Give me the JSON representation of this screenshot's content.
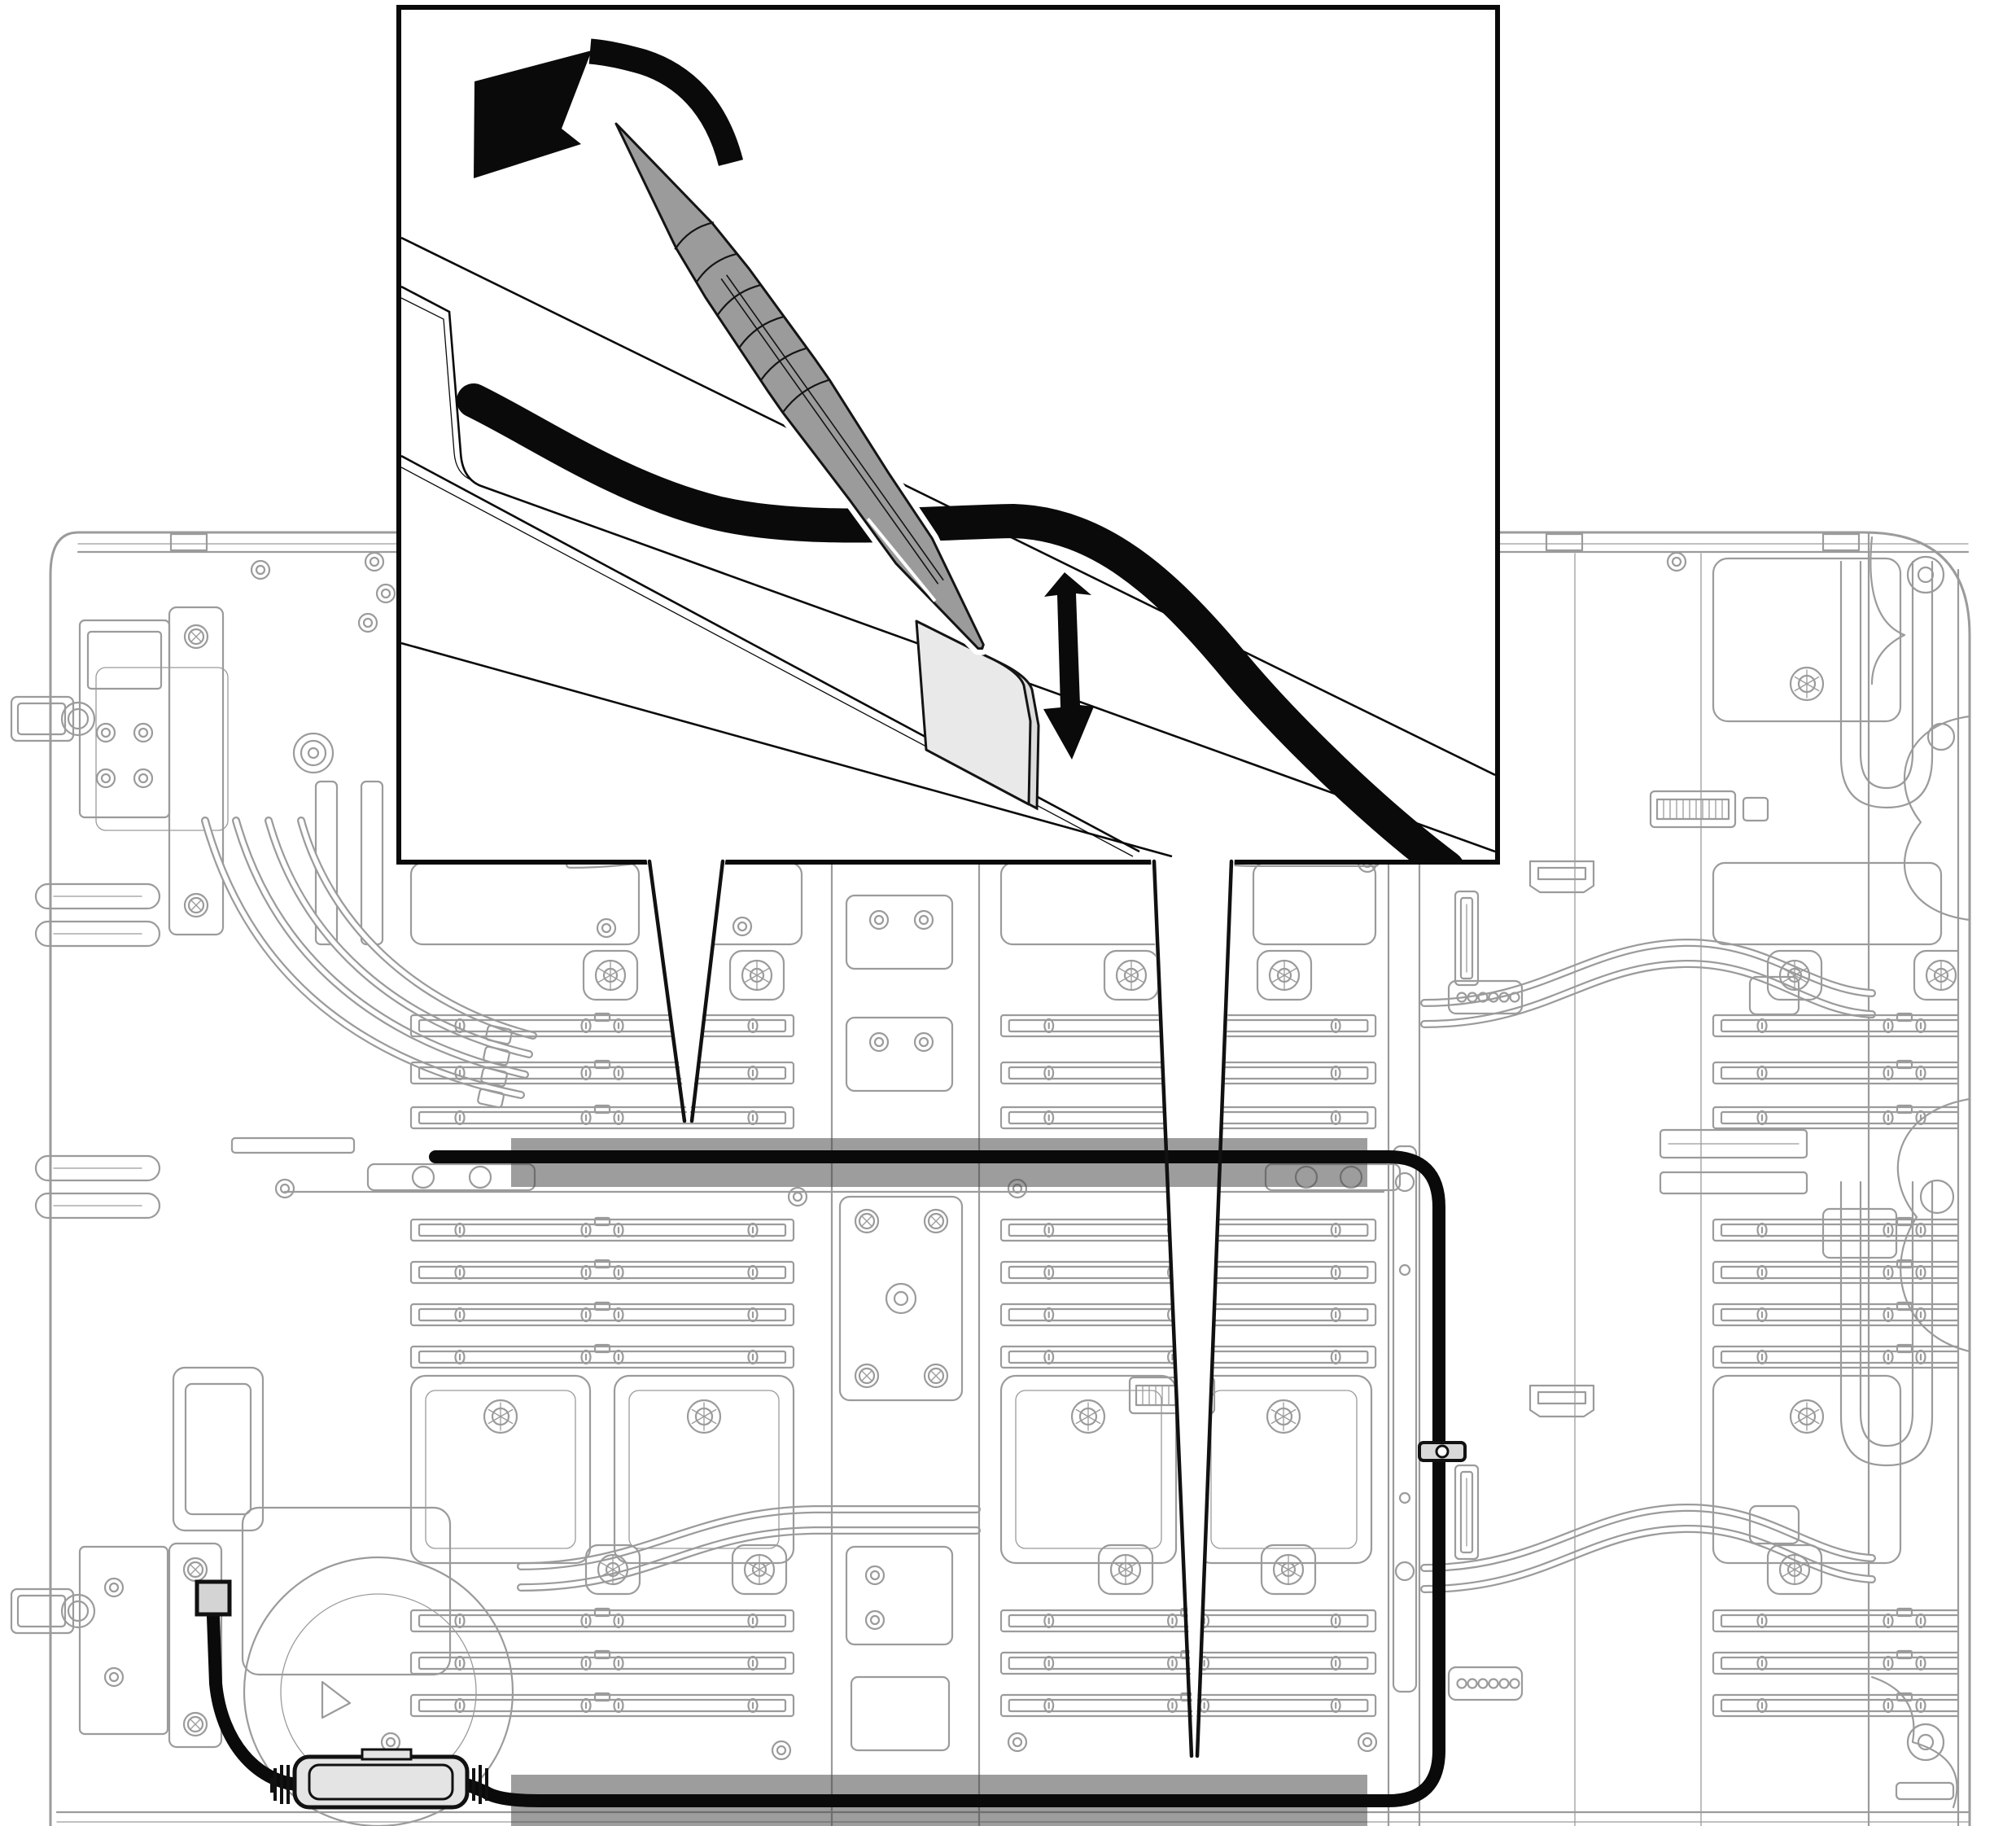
{
  "meta": {
    "kind": "hardware-service-illustration",
    "subject": "Water-cooled dual-node server tray: releasing a cable from its channel with a pointed pry tool",
    "background": "#ffffff"
  },
  "colors": {
    "line_art": "#9b9b9b",
    "ink": "#0a0a0a",
    "tool_fill": "#9b9b9b",
    "tab_fill": "#e9e9e9",
    "bar_fill": "rgba(70,70,70,0.53)",
    "component_fill": "#e4e4e4",
    "clip_fill": "#d8d8d8",
    "connector_fill": "#d4d4d4",
    "inset_border": "#0a0a0a",
    "white": "#ffffff"
  },
  "inset": {
    "border_color": "#0a0a0a",
    "icons": [
      {
        "name": "rotate-counterclockwise-arrow",
        "meaning": "rotate / pry the tool"
      },
      {
        "name": "up-down-arrow",
        "meaning": "move tab up and down"
      }
    ],
    "parts": [
      {
        "name": "pry-tool"
      },
      {
        "name": "cable"
      },
      {
        "name": "mylar-tab"
      },
      {
        "name": "sheet-metal-slot"
      }
    ]
  },
  "board": {
    "highlight_bars": [
      {
        "name": "upper-cable-channel"
      },
      {
        "name": "lower-cable-channel"
      }
    ],
    "callouts": [
      {
        "name": "left-funnel",
        "points_to": "upper-cable-channel"
      },
      {
        "name": "right-funnel",
        "points_to": "lower-cable-channel"
      }
    ],
    "parts": [
      {
        "name": "cable-assembly"
      },
      {
        "name": "cable-clip"
      },
      {
        "name": "inline-cable-retainer"
      },
      {
        "name": "cable-connector"
      }
    ]
  }
}
